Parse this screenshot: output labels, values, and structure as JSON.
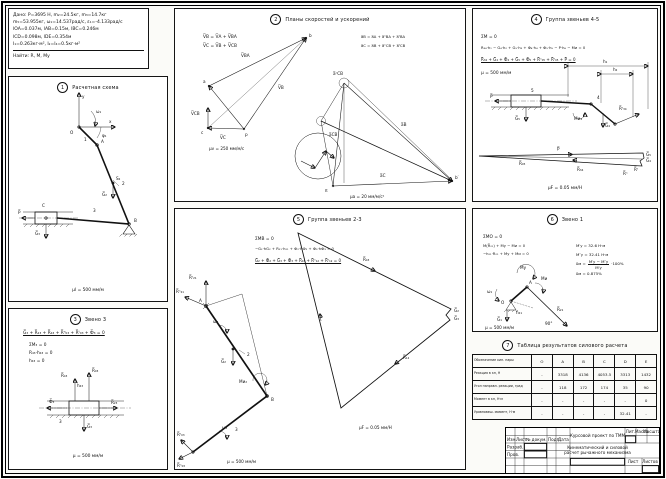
{
  "given": {
    "l1": "Дано: P=3695 Н, m₂=24.5кг, m₃=14.7кг",
    "l2": "m₅=53.955кг, ω₁=14.537рад/с, ε₁=-4.133рад/с",
    "l3": "lOA=0.037м, lAB=0.15м, lBC=0.246м",
    "l4": "lCD=0.098м, lDE=0.354м",
    "l5": "I₁=0.263кг·м², I₂=I₄=0.5кг·м²",
    "find": "Найти: R, M, Mу"
  },
  "p1": {
    "num": "1",
    "title": "Расчетная схема",
    "scale": "μl = 500 мм/м",
    "lb": {
      "y": "y",
      "x": "x",
      "O": "O",
      "A": "A",
      "B": "B",
      "C": "C",
      "n1": "1",
      "n2": "2",
      "n3": "3",
      "w1": "ω₁",
      "f1": "φ₁",
      "S2": "S₂",
      "G2": "G̅₂",
      "G3": "G̅₃",
      "P": "P̅"
    }
  },
  "p2": {
    "num": "2",
    "title": "Планы скоростей и ускорений",
    "ev1": "V̅B = V̅A + V̅BA",
    "ev2": "V̅C = V̅B + V̅CB",
    "ea1": "a̅B = a̅A + a̅ⁿBA + a̅ᵗBA",
    "ea2": "a̅C = a̅B + a̅ⁿCB + a̅ᵗCB",
    "sv": "μv = 250 мм/м/с",
    "sa": "μa = 20 мм/м/с²",
    "lb": {
      "p": "p",
      "a": "a",
      "b": "b",
      "c": "c",
      "vba": "V̅BA",
      "vb": "V̅B",
      "vcb": "V̅CB",
      "vc": "V̅C",
      "pi": "π",
      "b1": "b′",
      "ab": "a̅B",
      "ac": "a̅C",
      "acb": "a̅CB",
      "ancb": "a̅ⁿCB"
    }
  },
  "p3": {
    "num": "3",
    "title": "Звено 3",
    "e1": "G̅₃ + R̅₂₃ + R̅₄₃ + R̅ⁿ₀₃ + R̅ᵗ₀₃ + Ф̅₃ = 0",
    "e2": "ΣM₃ = 0",
    "e3": "R₄₃·h₄₃ = 0",
    "e4": "h₄₃ = 0",
    "scale": "μ = 500 мм/м",
    "lb": {
      "r43": "R̅₄₃",
      "r03": "R̅₀₃",
      "f": "Ф̅₃",
      "g3": "G̅₃",
      "r23": "R̅₂₃",
      "n3": "3",
      "h43": "h₄₃"
    }
  },
  "p4": {
    "num": "4",
    "title": "Группа звеньев 4-5",
    "e1": "ΣM = 0",
    "e2": "R₃₄·h₁ − G₄·h₂ + G₅·h₃ + Ф₄·h₄ + Ф₅·h₅ − P·h₆ − Mи = 0",
    "e3": "R̅₃₄ + G̅₄ + Ф̅₄ + G̅₅ + Ф̅₅ + R̅ⁿ₀₅ + R̅ᵗ₀₅ + P̅ = 0",
    "sl": "μ = 500 мм/м",
    "sf": "μF = 0.05 мм/Н",
    "lb": {
      "h1": "h₁",
      "h2": "h₂",
      "g5": "G̅₅",
      "g4": "G̅₄",
      "p": "P̅",
      "rt": "R̅ᵗ₃₄",
      "n4": "4",
      "n5": "5",
      "mi": "Mи₄",
      "pp": "P̅",
      "r05": "R̅₀₅",
      "r34": "R̅₃₄",
      "sg5": "G̅₅",
      "sg4": "G̅₄",
      "srt": "R̅ᵗ",
      "srn": "R̅ⁿ"
    }
  },
  "p5": {
    "num": "5",
    "title": "Группа звеньев 2-3",
    "e1": "ΣMB = 0",
    "e2": "−G₂·hG₂ + R₂₁·h₂₁ + Ф₂·hФ₂ + Ф₃·hФ₃ = 0",
    "e3": "G̅₂ + Ф̅₂ + G̅₃ + Ф̅₃ + R̅₄₃ + R̅ⁿ₁₂ + R̅ᵗ₁₂ = 0",
    "sl": "μ = 500 мм/м",
    "sf": "μF = 0.05 мм/Н",
    "lb": {
      "A": "A",
      "B": "B",
      "n2": "2",
      "n3": "3",
      "g2": "G̅₂",
      "rt21": "R̅ᵗ₂₁",
      "rn21": "R̅ⁿ₂₁",
      "mi2": "Mи₂",
      "w2": "ω₂",
      "w3": "ω₃",
      "rt03": "R̅ᵗ₀₃",
      "rn03": "R̅ⁿ₀₃",
      "pr43": "R̅₄₃",
      "pg2": "G̅₂",
      "pg3": "G̅₃",
      "pr12": "R̅₁₂"
    }
  },
  "p6": {
    "num": "6",
    "title": "Звено 1",
    "e1": "ΣMO = 0",
    "e2": "M(R̅₂₁) + Mу − Mи = 0",
    "e3": "−h₂₁·R₂₁ + Mу + Mи = 0",
    "r1": "M′у = 32.6 Н·м",
    "r2": "M″у = 32.41 Н·м",
    "d_lhs": "δм =",
    "d_num": "M′у − M″у",
    "d_den": "M′у",
    "d_tail": "·100%",
    "r4": "δм = 0.875%",
    "scale": "μ = 500 мм/м",
    "lb": {
      "O": "O",
      "A": "A",
      "g1": "G̅₁",
      "r21": "R̅₂₁",
      "my": "Mу",
      "mi": "Mи",
      "w1": "ω₁",
      "h21": "h₂₁",
      "ang": "90°"
    }
  },
  "tbl": {
    "num": "7",
    "title": "Таблица результатов силового расчета",
    "c0": "Обозначение кин. пары",
    "c1": "O",
    "c2": "A",
    "c3": "B",
    "c4": "C",
    "c5": "D",
    "c6": "E",
    "r1l": "Реакция в кп, Н",
    "r1": [
      "-",
      "3318",
      "4136",
      "4053.5",
      "3313",
      "1432"
    ],
    "r2l": "Угол направл. реакции, град",
    "r2": [
      "-",
      "118",
      "172",
      "174",
      "35",
      "90"
    ],
    "r3l": "Момент в кп, Н·м",
    "r3": [
      "-",
      "-",
      "-",
      "-",
      "-",
      "0"
    ],
    "r4l": "Уравновеш. момент, Н·м",
    "r4": [
      "-",
      "-",
      "-",
      "-",
      "32.41",
      "-"
    ]
  },
  "stamp": {
    "title": "Курсовой проект по ТММ",
    "doc1": "Кинематический и силовой",
    "doc2": "расчет рычажного механизма",
    "h_izm": "Изм.",
    "h_list": "Лист",
    "h_doc": "№ докум.",
    "h_podp": "Подп.",
    "h_data": "Дата",
    "razrab": "Разраб.",
    "prov": "Пров.",
    "lit": "Лит.",
    "massa": "Масса",
    "masshtab": "Масштаб",
    "list": "Лист",
    "listov": "Листов"
  }
}
